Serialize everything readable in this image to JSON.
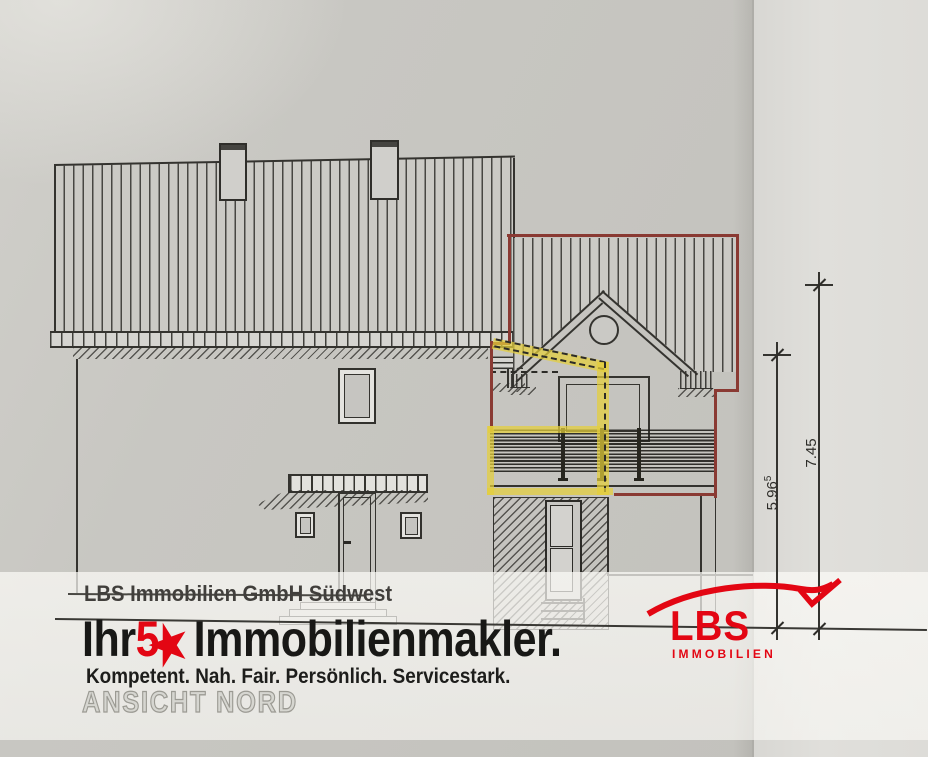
{
  "branding": {
    "company_line": "LBS Immobilien GmbH Südwest",
    "headline": {
      "prefix": "Ihr",
      "number": "5",
      "star": "★",
      "suffix": "Immobilienmakler."
    },
    "tagline": "Kompetent. Nah. Fair. Persönlich. Servicestark.",
    "logo": {
      "text": "LBS",
      "subtext": "IMMOBILIEN"
    }
  },
  "drawing": {
    "view_title": "ANSICHT NORD",
    "dimensions": [
      {
        "id": "eave-height",
        "value": "5.96",
        "sup": "5"
      },
      {
        "id": "ridge-height",
        "value": "7.45",
        "sup": ""
      }
    ]
  },
  "colors": {
    "accent_red": "#e30613",
    "outline_red": "#8a3a33",
    "highlight_yellow": "#e4ce3a",
    "line_dark": "#34332f",
    "paper": "#c8c7c2",
    "paper_light": "#dcdbd7"
  }
}
